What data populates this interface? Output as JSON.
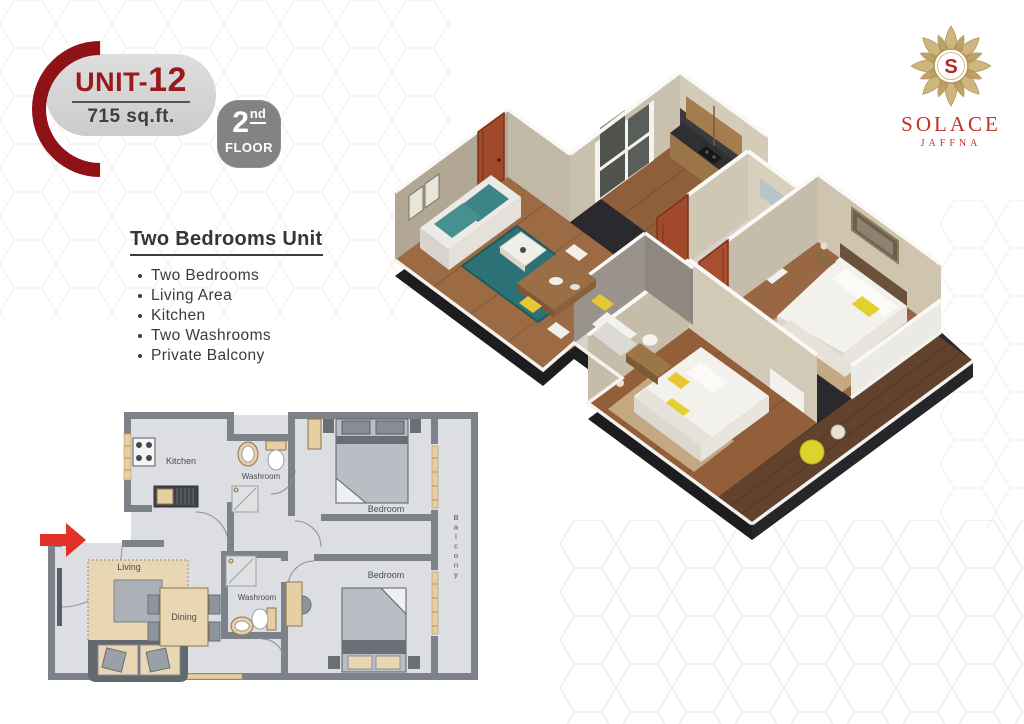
{
  "badge": {
    "unit_prefix": "UNIT-",
    "unit_number": "12",
    "area": "715 sq.ft.",
    "floor_number": "2",
    "floor_ordinal": "nd",
    "floor_word": "FLOOR"
  },
  "logo": {
    "monogram": "S",
    "brand": "SOLACE",
    "city": "JAFFNA"
  },
  "features": {
    "heading": "Two Bedrooms Unit",
    "items": [
      {
        "label": "Two Bedrooms"
      },
      {
        "label": "Living Area"
      },
      {
        "label": "Kitchen"
      },
      {
        "label": "Two Washrooms"
      },
      {
        "label": "Private Balcony"
      }
    ]
  },
  "floorplan_2d": {
    "labels": {
      "kitchen": "Kitchen",
      "washroom_top": "Washroom",
      "bedroom_top": "Bedroom",
      "balcony": "Balcony",
      "living": "Living",
      "dining": "Dining",
      "washroom_bottom": "Washroom",
      "bedroom_bottom": "Bedroom"
    }
  },
  "colors": {
    "accent_red": "#9a191d",
    "entry_arrow_red": "#e23127",
    "logo_gold": "#b5975a",
    "logo_red": "#c23128",
    "badge_grey": "#d5d5d6",
    "floor_badge_grey": "#828385",
    "plan_wall_grey": "#7d828a",
    "plan_fixture_tan": "#e7cfa3",
    "render_wood": "#9a6843",
    "render_teal": "#2c7276",
    "render_yellow": "#e3cf2e",
    "render_door_red": "#a14a2b"
  }
}
